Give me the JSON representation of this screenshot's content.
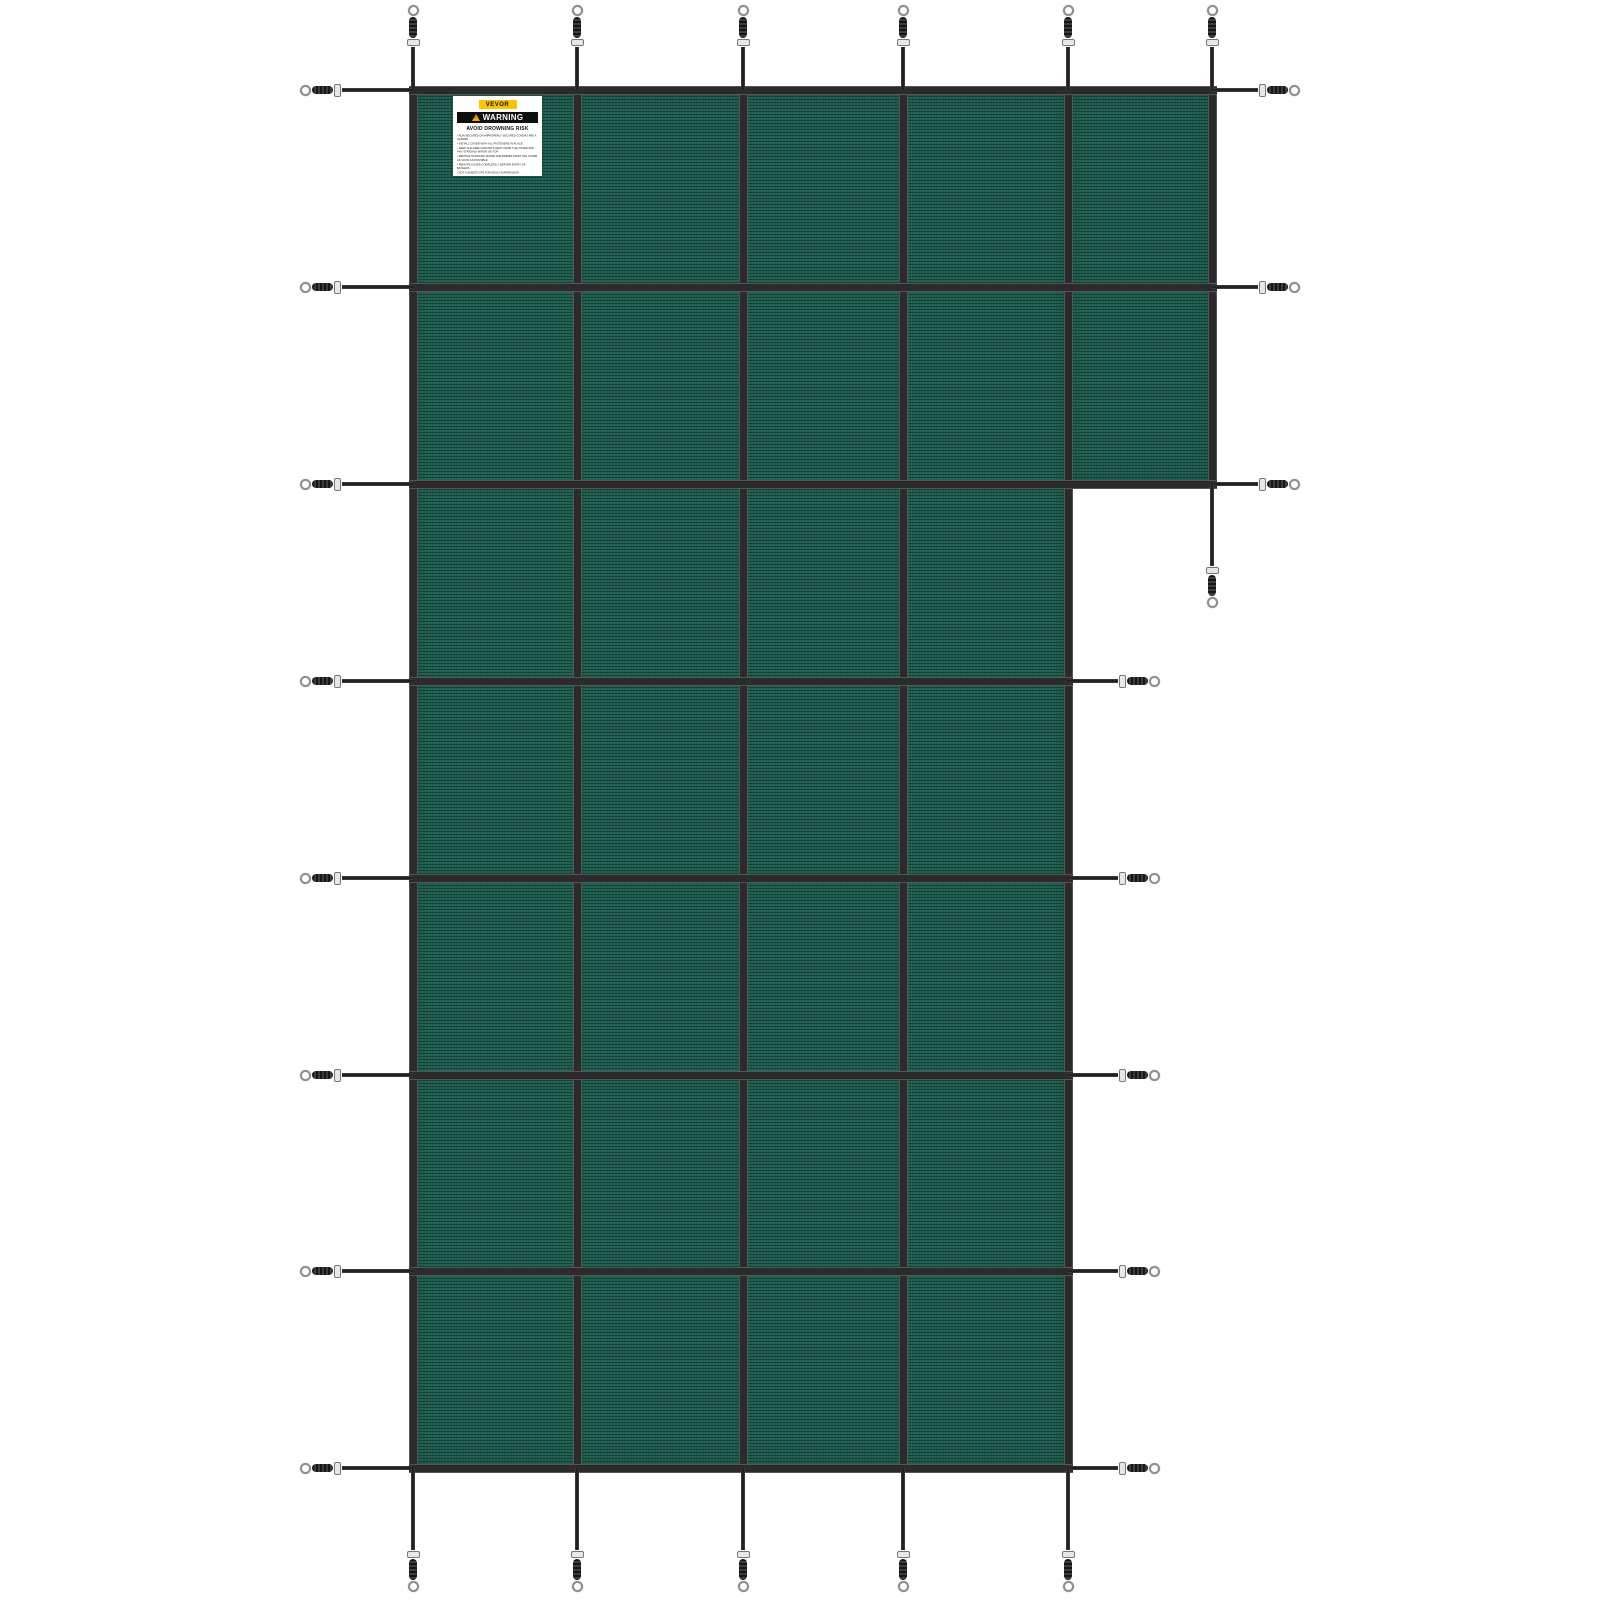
{
  "canvas": {
    "width": 1600,
    "height": 1600
  },
  "colors": {
    "background": "#FFFFFF",
    "mesh": "#1F5F50",
    "rib": "#113B31",
    "strap": "#2B2B2B",
    "spring": "#161616",
    "buckle": "#E8E8E8",
    "ring": "#8F8F8F",
    "label_bg": "#FFFFFF",
    "brand_yellow": "#F6C700",
    "warning_bar": "#0E0E0E",
    "warning_triangle": "#F7A600"
  },
  "label": {
    "brand": "VEVOR",
    "heading": "WARNING",
    "subheading": "AVOID DROWNING RISK",
    "lines": [
      "NON-SECURED OR IMPROPERLY SECURED COVERS ARE A HAZARD",
      "INSTALL COVER WITH ALL FASTENERS IN PLACE",
      "KEEP CHILDREN AND PETS AWAY FROM THE COVER AND ANY STANDING WATER ON TOP",
      "REMOVE STANDING WATER AND DEBRIS FROM THE COVER AS SOON AS POSSIBLE",
      "REMOVE COVER COMPLETELY BEFORE ENTRY OF BATHERS",
      "NOT A SUBSTITUTE FOR ADULT SUPERVISION"
    ]
  },
  "cover": {
    "panels": [
      {
        "id": "main",
        "left": 413,
        "top": 90,
        "width": 655,
        "height": 1378
      },
      {
        "id": "extension",
        "left": 1068,
        "top": 90,
        "width": 144,
        "height": 394
      }
    ],
    "vertical_straps": [
      {
        "x": 413,
        "from": 90,
        "to": 1468
      },
      {
        "x": 577,
        "from": 90,
        "to": 1468
      },
      {
        "x": 743,
        "from": 90,
        "to": 1468
      },
      {
        "x": 903,
        "from": 90,
        "to": 1468
      },
      {
        "x": 1068,
        "from": 90,
        "to": 1468
      },
      {
        "x": 1212,
        "from": 90,
        "to": 484
      }
    ],
    "horizontal_straps": [
      {
        "y": 90,
        "from": 413,
        "to": 1212
      },
      {
        "y": 287,
        "from": 413,
        "to": 1212
      },
      {
        "y": 484,
        "from": 413,
        "to": 1212
      },
      {
        "y": 681,
        "from": 413,
        "to": 1068
      },
      {
        "y": 878,
        "from": 413,
        "to": 1068
      },
      {
        "y": 1075,
        "from": 413,
        "to": 1068
      },
      {
        "y": 1271,
        "from": 413,
        "to": 1068
      },
      {
        "y": 1468,
        "from": 413,
        "to": 1068
      }
    ],
    "anchors": [
      {
        "dir": "left",
        "x": 413,
        "y": 90,
        "len": 113
      },
      {
        "dir": "left",
        "x": 413,
        "y": 287,
        "len": 113
      },
      {
        "dir": "left",
        "x": 413,
        "y": 484,
        "len": 113
      },
      {
        "dir": "left",
        "x": 413,
        "y": 681,
        "len": 113
      },
      {
        "dir": "left",
        "x": 413,
        "y": 878,
        "len": 113
      },
      {
        "dir": "left",
        "x": 413,
        "y": 1075,
        "len": 113
      },
      {
        "dir": "left",
        "x": 413,
        "y": 1271,
        "len": 113
      },
      {
        "dir": "left",
        "x": 413,
        "y": 1468,
        "len": 113
      },
      {
        "dir": "right",
        "x": 1212,
        "y": 90,
        "len": 88
      },
      {
        "dir": "right",
        "x": 1212,
        "y": 287,
        "len": 88
      },
      {
        "dir": "right",
        "x": 1212,
        "y": 484,
        "len": 88
      },
      {
        "dir": "right",
        "x": 1068,
        "y": 681,
        "len": 92
      },
      {
        "dir": "right",
        "x": 1068,
        "y": 878,
        "len": 92
      },
      {
        "dir": "right",
        "x": 1068,
        "y": 1075,
        "len": 92
      },
      {
        "dir": "right",
        "x": 1068,
        "y": 1271,
        "len": 92
      },
      {
        "dir": "right",
        "x": 1068,
        "y": 1468,
        "len": 92
      },
      {
        "dir": "up",
        "x": 413,
        "y": 90,
        "len": 85
      },
      {
        "dir": "up",
        "x": 577,
        "y": 90,
        "len": 85
      },
      {
        "dir": "up",
        "x": 743,
        "y": 90,
        "len": 85
      },
      {
        "dir": "up",
        "x": 903,
        "y": 90,
        "len": 85
      },
      {
        "dir": "up",
        "x": 1068,
        "y": 90,
        "len": 85
      },
      {
        "dir": "up",
        "x": 1212,
        "y": 90,
        "len": 85
      },
      {
        "dir": "down",
        "x": 413,
        "y": 1468,
        "len": 124
      },
      {
        "dir": "down",
        "x": 577,
        "y": 1468,
        "len": 124
      },
      {
        "dir": "down",
        "x": 743,
        "y": 1468,
        "len": 124
      },
      {
        "dir": "down",
        "x": 903,
        "y": 1468,
        "len": 124
      },
      {
        "dir": "down",
        "x": 1068,
        "y": 1468,
        "len": 124
      },
      {
        "dir": "down",
        "x": 1212,
        "y": 484,
        "len": 124
      }
    ]
  }
}
